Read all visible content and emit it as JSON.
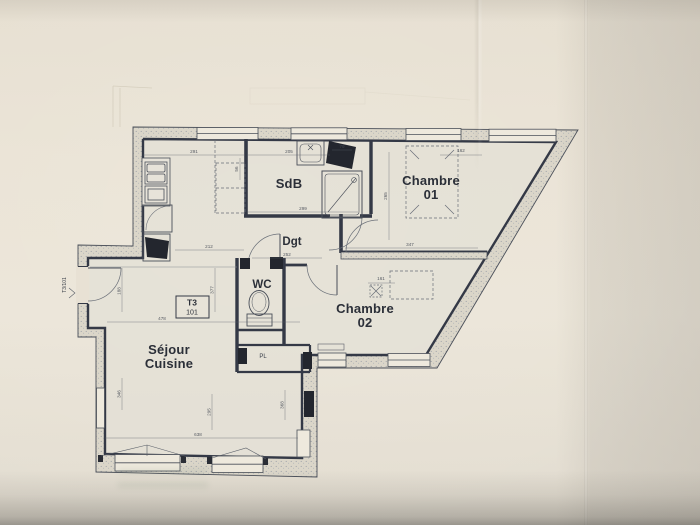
{
  "unit": {
    "type": "T3",
    "number": "101",
    "door_label": "T3/101"
  },
  "rooms": {
    "sdb": "SdB",
    "dgt": "Dgt",
    "wc": "WC",
    "chambre1_line1": "Chambre",
    "chambre1_line2": "01",
    "chambre2_line1": "Chambre",
    "chambre2_line2": "02",
    "sejour_line1": "Séjour",
    "sejour_line2": "Cuisine",
    "pl": "PL"
  },
  "dimensions": {
    "d291": "291",
    "d205": "205",
    "d299": "299",
    "d79": "79",
    "d265": "265",
    "d162": "162",
    "d347": "347",
    "d161": "161",
    "d212": "212",
    "d252": "252",
    "d56": "56",
    "d188": "188",
    "d377": "377",
    "d478": "478",
    "d638": "638",
    "d295": "295",
    "d346": "346",
    "d368": "368"
  },
  "colors": {
    "paper": "#eae3d5",
    "ink": "#343946",
    "wall_fill": "#dbd6c9",
    "dashed_furniture": "#6a6f78"
  }
}
